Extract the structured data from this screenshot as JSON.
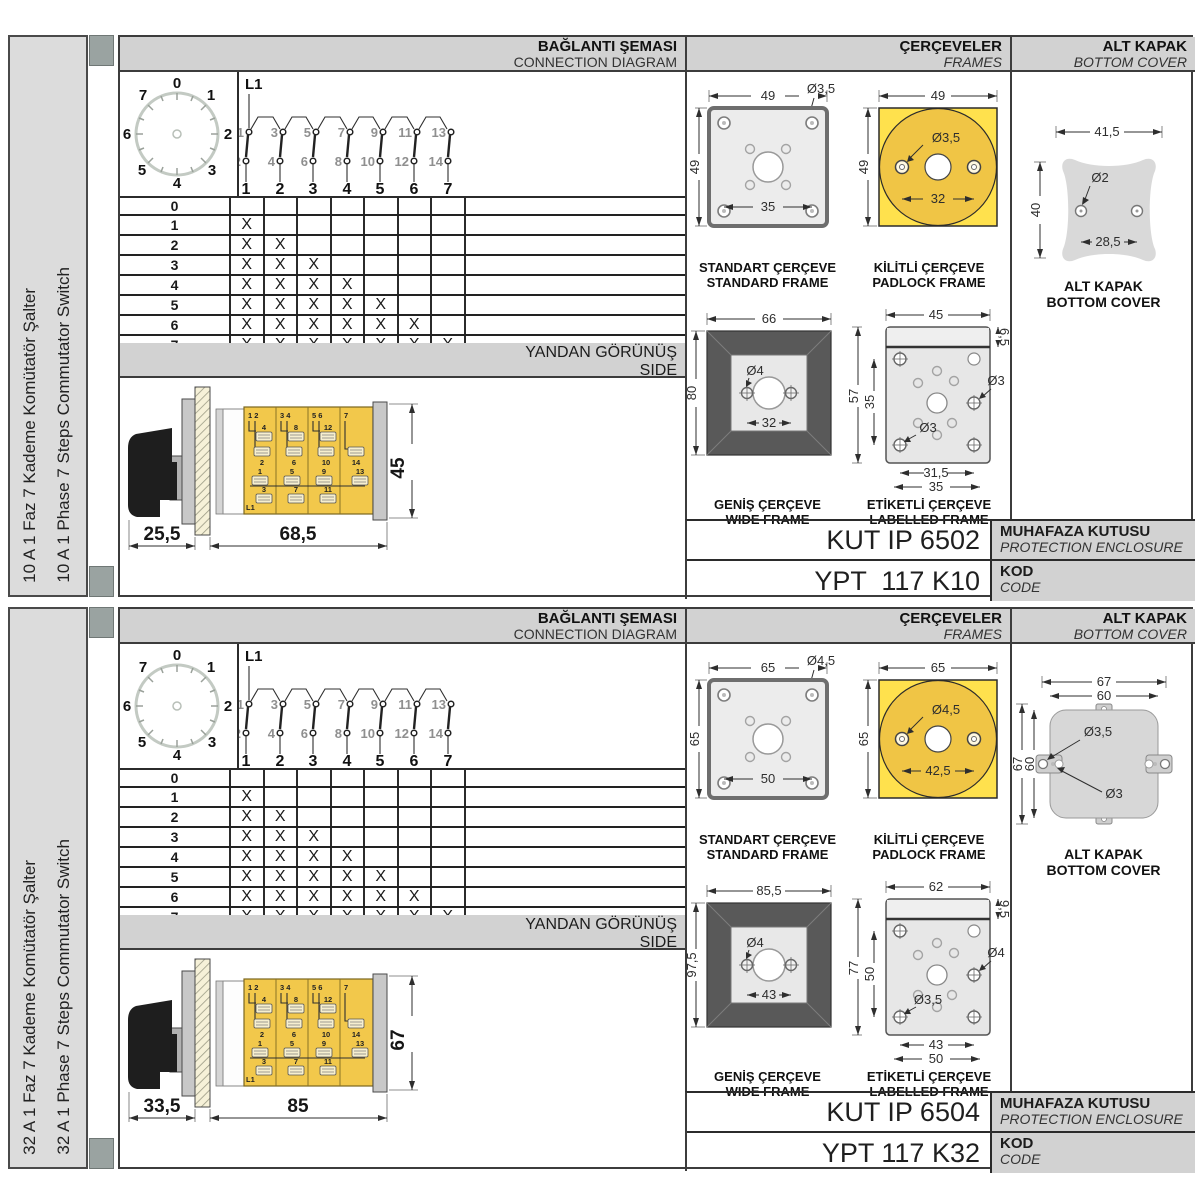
{
  "shared": {
    "headers": {
      "connection_tr": "BAĞLANTI ŞEMASI",
      "connection_en": "CONNECTION DIAGRAM",
      "frames_tr": "ÇERÇEVELER",
      "frames_en": "FRAMES",
      "cover_tr": "ALT KAPAK",
      "cover_en": "BOTTOM COVER",
      "side_tr": "YANDAN GÖRÜNÜŞ",
      "side_en": "SIDE"
    },
    "dial": {
      "labels": [
        "0",
        "1",
        "2",
        "3",
        "4",
        "5",
        "6",
        "7"
      ]
    },
    "contacts": {
      "phase": "L1",
      "top": [
        "1",
        "3",
        "5",
        "7",
        "9",
        "11",
        "13"
      ],
      "bottom": [
        "2",
        "4",
        "6",
        "8",
        "10",
        "12",
        "14"
      ],
      "out": [
        "1",
        "2",
        "3",
        "4",
        "5",
        "6",
        "7"
      ]
    },
    "step_table": {
      "rows": [
        {
          "label": "0",
          "m": [
            "",
            "",
            "",
            "",
            "",
            "",
            ""
          ]
        },
        {
          "label": "1",
          "m": [
            "X",
            "",
            "",
            "",
            "",
            "",
            ""
          ]
        },
        {
          "label": "2",
          "m": [
            "X",
            "X",
            "",
            "",
            "",
            "",
            ""
          ]
        },
        {
          "label": "3",
          "m": [
            "X",
            "X",
            "X",
            "",
            "",
            "",
            ""
          ]
        },
        {
          "label": "4",
          "m": [
            "X",
            "X",
            "X",
            "X",
            "",
            "",
            ""
          ]
        },
        {
          "label": "5",
          "m": [
            "X",
            "X",
            "X",
            "X",
            "X",
            "",
            ""
          ]
        },
        {
          "label": "6",
          "m": [
            "X",
            "X",
            "X",
            "X",
            "X",
            "X",
            ""
          ]
        },
        {
          "label": "7",
          "m": [
            "X",
            "X",
            "X",
            "X",
            "X",
            "X",
            "X"
          ]
        }
      ]
    },
    "switch_body": {
      "phase": "L1",
      "cols": [
        {
          "top": "1 2",
          "u1": "4",
          "u2": "2",
          "l1": "1",
          "l2": "3"
        },
        {
          "top": "3 4",
          "u1": "8",
          "u2": "6",
          "l1": "5",
          "l2": "7"
        },
        {
          "top": "5 6",
          "u1": "12",
          "u2": "10",
          "l1": "9",
          "l2": "11"
        },
        {
          "top": "7",
          "u1": "",
          "u2": "14",
          "l1": "13",
          "l2": ""
        }
      ]
    },
    "captions": {
      "standard_tr": "STANDART ÇERÇEVE",
      "standard_en": "STANDARD FRAME",
      "padlock_tr": "KİLİTLİ ÇERÇEVE",
      "padlock_en": "PADLOCK FRAME",
      "wide_tr": "GENİŞ ÇERÇEVE",
      "wide_en": "WIDE FRAME",
      "labelled_tr": "ETİKETLİ ÇERÇEVE",
      "labelled_en": "LABELLED FRAME",
      "cover_tr": "ALT KAPAK",
      "cover_en": "BOTTOM COVER"
    },
    "code_labels": {
      "enclosure_tr": "MUHAFAZA KUTUSU",
      "enclosure_en": "PROTECTION ENCLOSURE",
      "kod_tr": "KOD",
      "kod_en": "CODE"
    }
  },
  "panels": [
    {
      "sidebar_tr": "10 A 1 Faz 7 Kademe Komütatör Şalter",
      "sidebar_en": "10 A 1 Phase 7 Steps Commutator Switch",
      "side_view": {
        "dim_front": "25,5",
        "dim_body": "68,5",
        "dim_height": "45"
      },
      "frames": {
        "standard": {
          "w": "49",
          "h": "49",
          "hole": "Ø3,5",
          "span": "35"
        },
        "padlock": {
          "w": "49",
          "h": "49",
          "hole": "Ø3,5",
          "span": "32"
        },
        "wide": {
          "w": "66",
          "h": "80",
          "hole": "Ø4",
          "span": "32"
        },
        "labelled": {
          "w": "45",
          "band": "6,5",
          "h": "57",
          "inner": "35",
          "hole_right": "Ø3",
          "hole_left": "Ø3",
          "span1": "31,5",
          "span2": "35"
        }
      },
      "cover": {
        "w": "41,5",
        "h": "40",
        "hole": "Ø2",
        "span": "28,5"
      },
      "enclosure_code": "KUT IP 6502",
      "code": "YPT  117 K10"
    },
    {
      "sidebar_tr": "32 A 1 Faz 7 Kademe Komütatör Şalter",
      "sidebar_en": "32 A 1 Phase 7 Steps Commutator Switch",
      "side_view": {
        "dim_front": "33,5",
        "dim_body": "85",
        "dim_height": "67"
      },
      "frames": {
        "standard": {
          "w": "65",
          "h": "65",
          "hole": "Ø4,5",
          "span": "50"
        },
        "padlock": {
          "w": "65",
          "h": "65",
          "hole": "Ø4,5",
          "span": "42,5"
        },
        "wide": {
          "w": "85,5",
          "h": "97,5",
          "hole": "Ø4",
          "span": "43"
        },
        "labelled": {
          "w": "62",
          "band": "9,5",
          "h": "77",
          "inner": "50",
          "hole_right": "Ø4",
          "hole_left": "Ø3,5",
          "span1": "43",
          "span2": "50"
        }
      },
      "cover": {
        "w": "67",
        "w2": "60",
        "h": "67",
        "h2": "60",
        "hole": "Ø3,5",
        "hole2": "Ø3"
      },
      "enclosure_code": "KUT IP 6504",
      "code": "YPT 117 K32"
    }
  ]
}
